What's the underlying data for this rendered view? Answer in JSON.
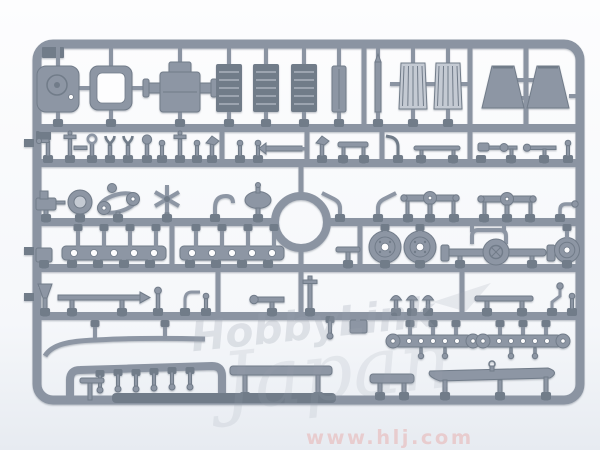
{
  "image": {
    "title": "Plastic model kit sprue photograph",
    "description": "Photograph of a gray injection-molded plastic model kit sprue (parts tree) on a white background: large hatch panel, hull frame, gearbox, slatted boxes, radiator grilles and fenders along the top, rows of small detail parts, road wheels and an axle with differential in the middle, perforated strips and long hull rods along the bottom, with a circular opening at the center of the runners."
  },
  "watermarks": {
    "logo_line1": "HobbyLink",
    "logo_line2": "Japan",
    "url": "www.hlj.com"
  },
  "colors": {
    "bg-top": "#fdfdfe",
    "bg-mid": "#f4f6f9",
    "bg-bottom": "#e7ebf1",
    "sprue": "#8b94a2",
    "sprue-dark": "#6e7987",
    "part": "#8d96a4",
    "part-dark": "#717b89",
    "part-light": "#c4cad3",
    "watermark-gray": "#9aa2ae",
    "watermark-pink": "#e8b9b9"
  },
  "sprue": {
    "plastic_color_name": "gray",
    "notable_parts": "hatch panel, hull frame, gearbox, slatted boxes, radiator grilles, fenders, road wheels, axle with differential, perforated strips, tool rods, long hull strips, center ring opening"
  }
}
